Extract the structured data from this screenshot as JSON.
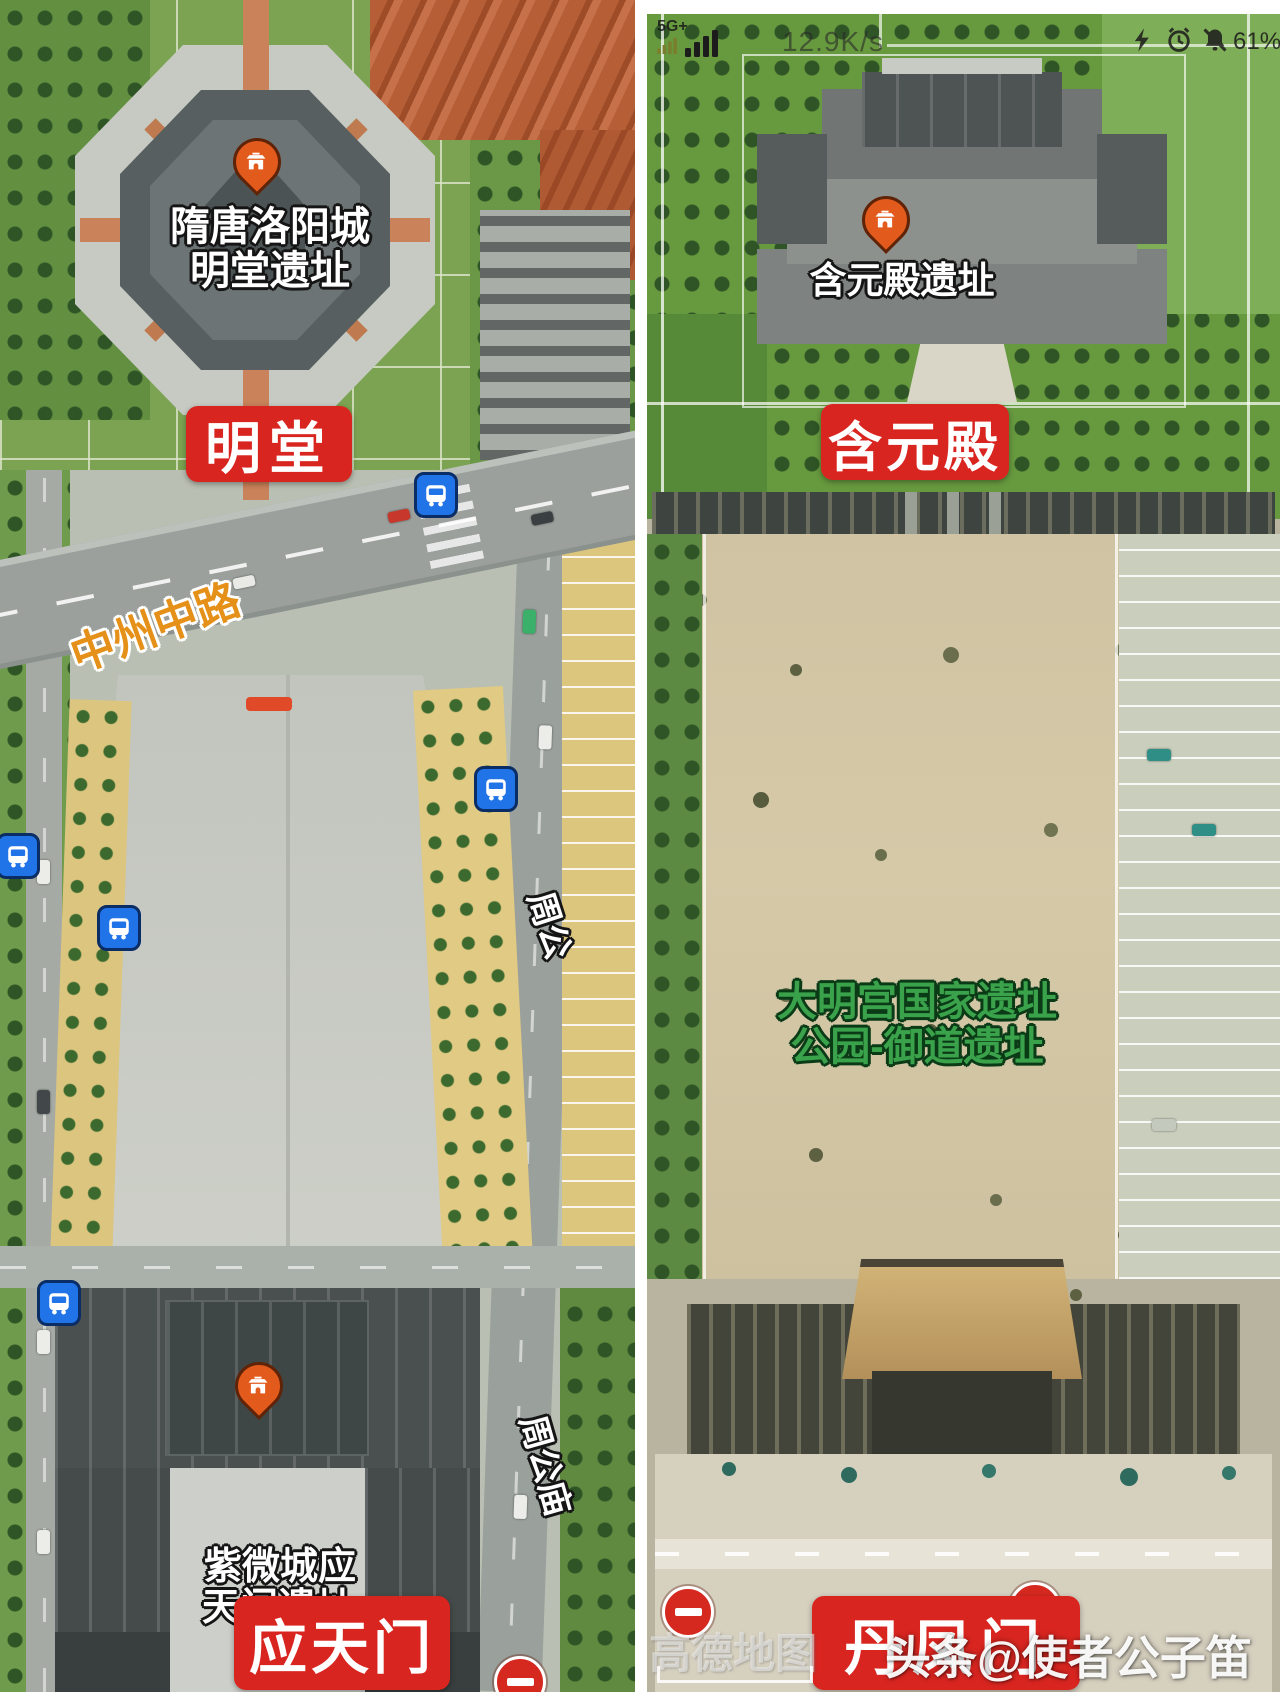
{
  "left_panel": {
    "poi": {
      "line1": "隋唐洛阳城",
      "line2": "明堂遗址"
    },
    "banner": "明堂",
    "road_main_label": "中州中路",
    "road_side_label_1": "周公",
    "road_side_label_2": "周公庙",
    "gate_poi": {
      "line1": "紫微城应",
      "line2": "天门遗址"
    },
    "gate_banner": "应天门"
  },
  "right_panel": {
    "status_bar": {
      "network": "5G+",
      "speed": "12.9K/s",
      "battery": "61%"
    },
    "poi_label": "含元殿遗址",
    "banner": "含元殿",
    "park_label": {
      "line1": "大明宫国家遗址",
      "line2": "公园-御道遗址"
    },
    "gate_banner": "丹凤门",
    "map_watermark": "高德地图",
    "author_watermark": "头条@使者公子笛"
  },
  "icons": {
    "poi_pin": "temple-gate-pin-icon",
    "bus_stop": "bus-stop-icon",
    "no_entry": "no-entry-icon",
    "signal": "signal-bars-icon",
    "mini_signal": "signal-bars-secondary-icon",
    "shortcut": "lightning-icon",
    "alarm": "alarm-clock-icon",
    "bell": "bell-muted-icon"
  },
  "colors": {
    "banner_red": "#d92520",
    "pin_orange": "#e35a1d",
    "bus_blue": "#2173e8",
    "no_entry_red": "#d5281f",
    "road_label_orange": "#e59018",
    "park_label_green": "#3aa24b"
  }
}
